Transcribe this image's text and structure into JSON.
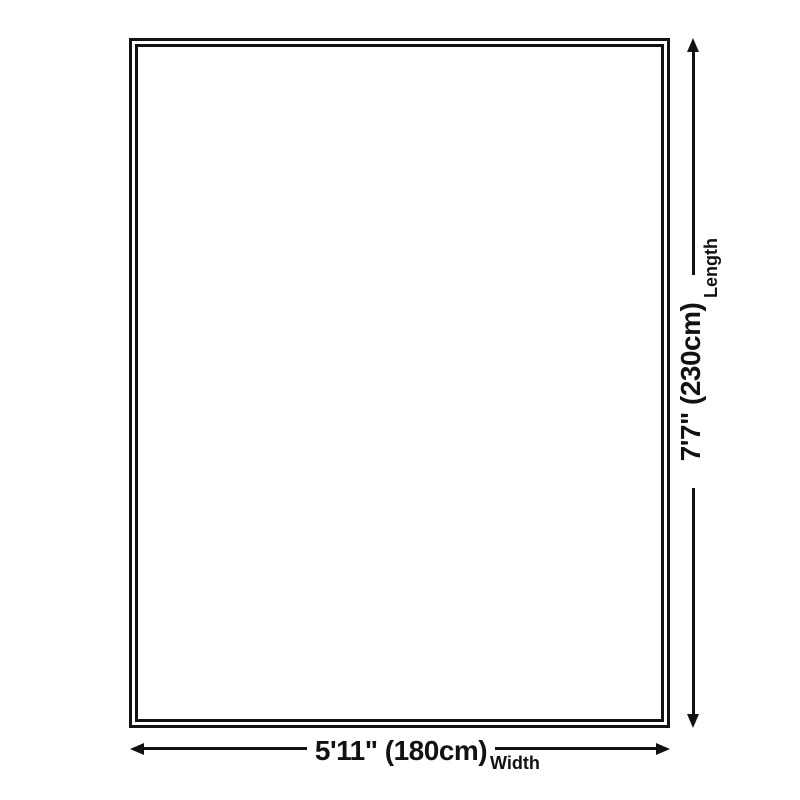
{
  "page": {
    "background_color": "#ffffff",
    "ink_color": "#121212"
  },
  "diagram": {
    "type": "product-dimension-diagram",
    "shape": "rectangle-double-border",
    "length": {
      "value": "7'7\" (230cm)",
      "label": "Length"
    },
    "width": {
      "value": "5'11\" (180cm)",
      "label": "Width"
    }
  }
}
